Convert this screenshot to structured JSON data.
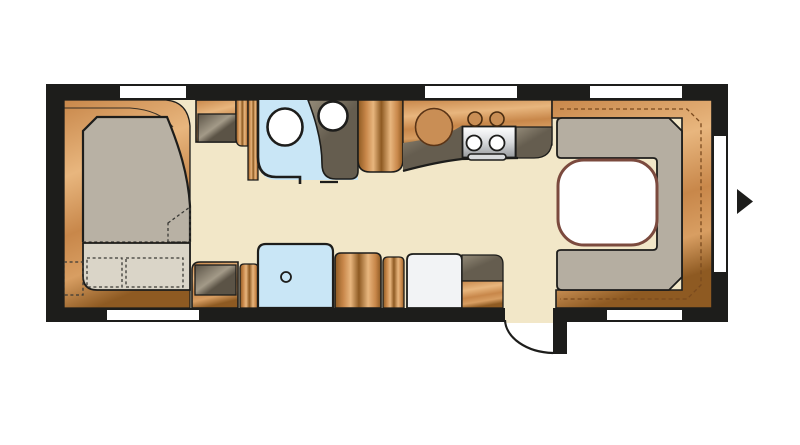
{
  "diagram": {
    "type": "caravan-floor-plan",
    "elements": {
      "bed": "double-bed",
      "bed_extension": "fold-out-seat-cushions",
      "wardrobe_top": "wardrobe",
      "wardrobe_bottom": "cabinet",
      "washroom": "toilet-and-basin",
      "shower": "shower-tray",
      "kitchen": "sink-and-hob",
      "oven": "oven",
      "fridge": "fridge",
      "dinette": "u-shaped-lounge",
      "table": "table",
      "door": "entry-door",
      "arrow": "entrance-direction-arrow",
      "windows": "windows"
    }
  },
  "colors": {
    "background": "#ffffff",
    "wall": "#1d1d1b",
    "floor": "#f2e7c8",
    "window": "#ffffff",
    "wood_dark": "#8e5a22",
    "wood_mid": "#c8874a",
    "wood_mid2": "#d89e62",
    "wood_light": "#e8b67e",
    "gray_front_light": "#a39a88",
    "gray_front_dark": "#5b5346",
    "taupe_light": "#948b79",
    "taupe_dark": "#655d4f",
    "wet_blue": "#c9e6f6",
    "mattress": "#b8b1a4",
    "cushion_light": "#dad5c8",
    "fold_light": "#e9e5da",
    "dinette_cushion": "#b5aea1",
    "table_fill": "#ffffff",
    "table_border": "#7b4a3e",
    "stove_light": "#ffffff",
    "stove_mid": "#d9dbdd",
    "stove_dark": "#96999c",
    "fridge": "#f2f3f5",
    "white_fixture": "#ffffff",
    "sink_wood": "#c98e55",
    "stitch": "#7a4a1e"
  }
}
